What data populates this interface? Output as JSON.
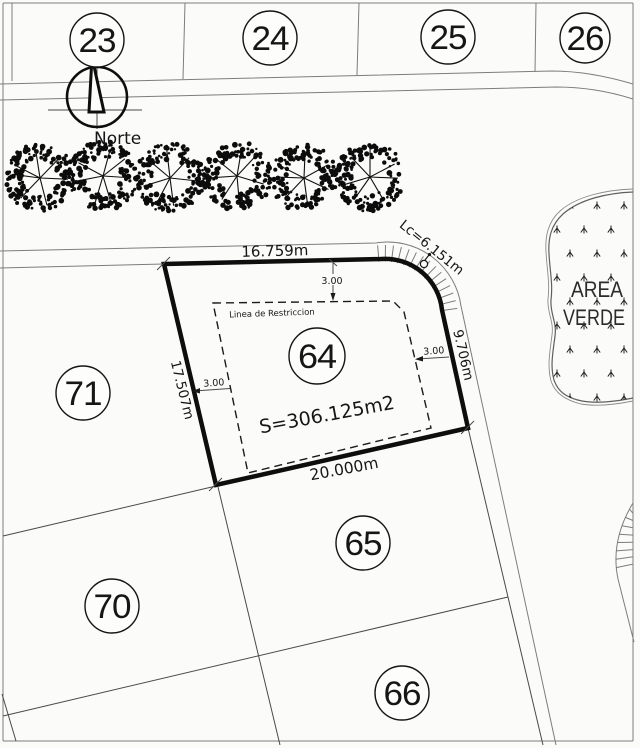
{
  "drawing": {
    "type": "site-plan",
    "north_label": "Norte",
    "green_area": {
      "label_line1": "AREA",
      "label_line2": "VERDE"
    }
  },
  "lots": {
    "top_row": [
      {
        "id": "23"
      },
      {
        "id": "24"
      },
      {
        "id": "25"
      },
      {
        "id": "26"
      }
    ],
    "focus": {
      "id": "64",
      "area_label": "S=306.125m2",
      "restriction_label": "Linea de Restriccion"
    },
    "neighbors": [
      {
        "id": "71"
      },
      {
        "id": "70"
      },
      {
        "id": "65"
      },
      {
        "id": "66"
      }
    ]
  },
  "dimensions": {
    "top_edge": "16.759m",
    "corner_curve": "Lc=6.151m",
    "right_edge": "9.706m",
    "left_edge": "17.507m",
    "bottom_edge": "20.000m",
    "setback_top": "3.00",
    "setback_left": "3.00",
    "setback_right": "3.00"
  },
  "icons": {
    "north_arrow": "north-arrow-icon",
    "tree": "tree-icon",
    "grass": "grass-tuft-icon",
    "street_light": "street-light-icon"
  },
  "colors": {
    "line_strong": "#0e0e0e",
    "line_thin": "#7d7d7d",
    "background": "#fbfbfa"
  }
}
